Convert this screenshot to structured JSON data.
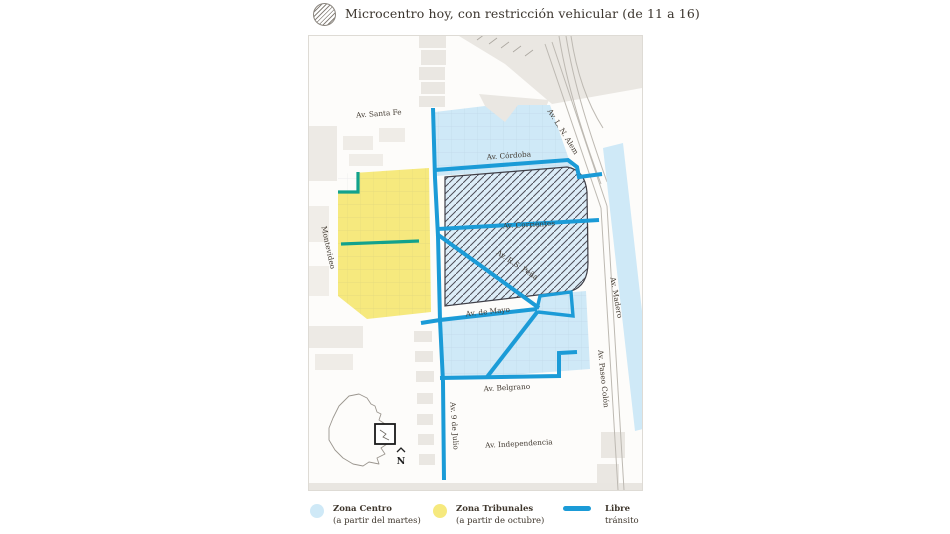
{
  "header": {
    "icon": "hatched-circle-icon",
    "title": "Microcentro hoy, con restricción vehicular (de 11 a 16)"
  },
  "colors": {
    "zone_centro": "#cfe9f7",
    "zone_tribunales": "#f6e97e",
    "microcentro_fill": "#ddedf8",
    "microcentro_outline": "#3f3f48",
    "libre_transito": "#1b9bd7",
    "teal_line": "#12a28c"
  },
  "map": {
    "street_labels": {
      "santa_fe": "Av. Santa Fe",
      "cordoba": "Av. Córdoba",
      "corrientes": "Av. Corrientes",
      "rs_pena": "Av. R.S. Peña",
      "de_mayo": "Av. de Mayo",
      "belgrano": "Av. Belgrano",
      "independencia": "Av. Independencia",
      "nueve_de_julio": "Av. 9 de Julio",
      "montevideo": "Montevideo",
      "alem": "Av. L. N. Alem",
      "madero": "Av. Madero",
      "paseo_colon": "Av. Paseo Colón"
    },
    "inset": {
      "north": "N"
    }
  },
  "legend": [
    {
      "swatch": "circle",
      "color": "#cfe9f7",
      "label": "Zona Centro",
      "sublabel": "(a partir del martes)"
    },
    {
      "swatch": "circle",
      "color": "#f6e97e",
      "label": "Zona Tribunales",
      "sublabel": "(a partir de octubre)"
    },
    {
      "swatch": "line",
      "color": "#1b9bd7",
      "label": "Libre",
      "sublabel": "tránsito"
    }
  ]
}
